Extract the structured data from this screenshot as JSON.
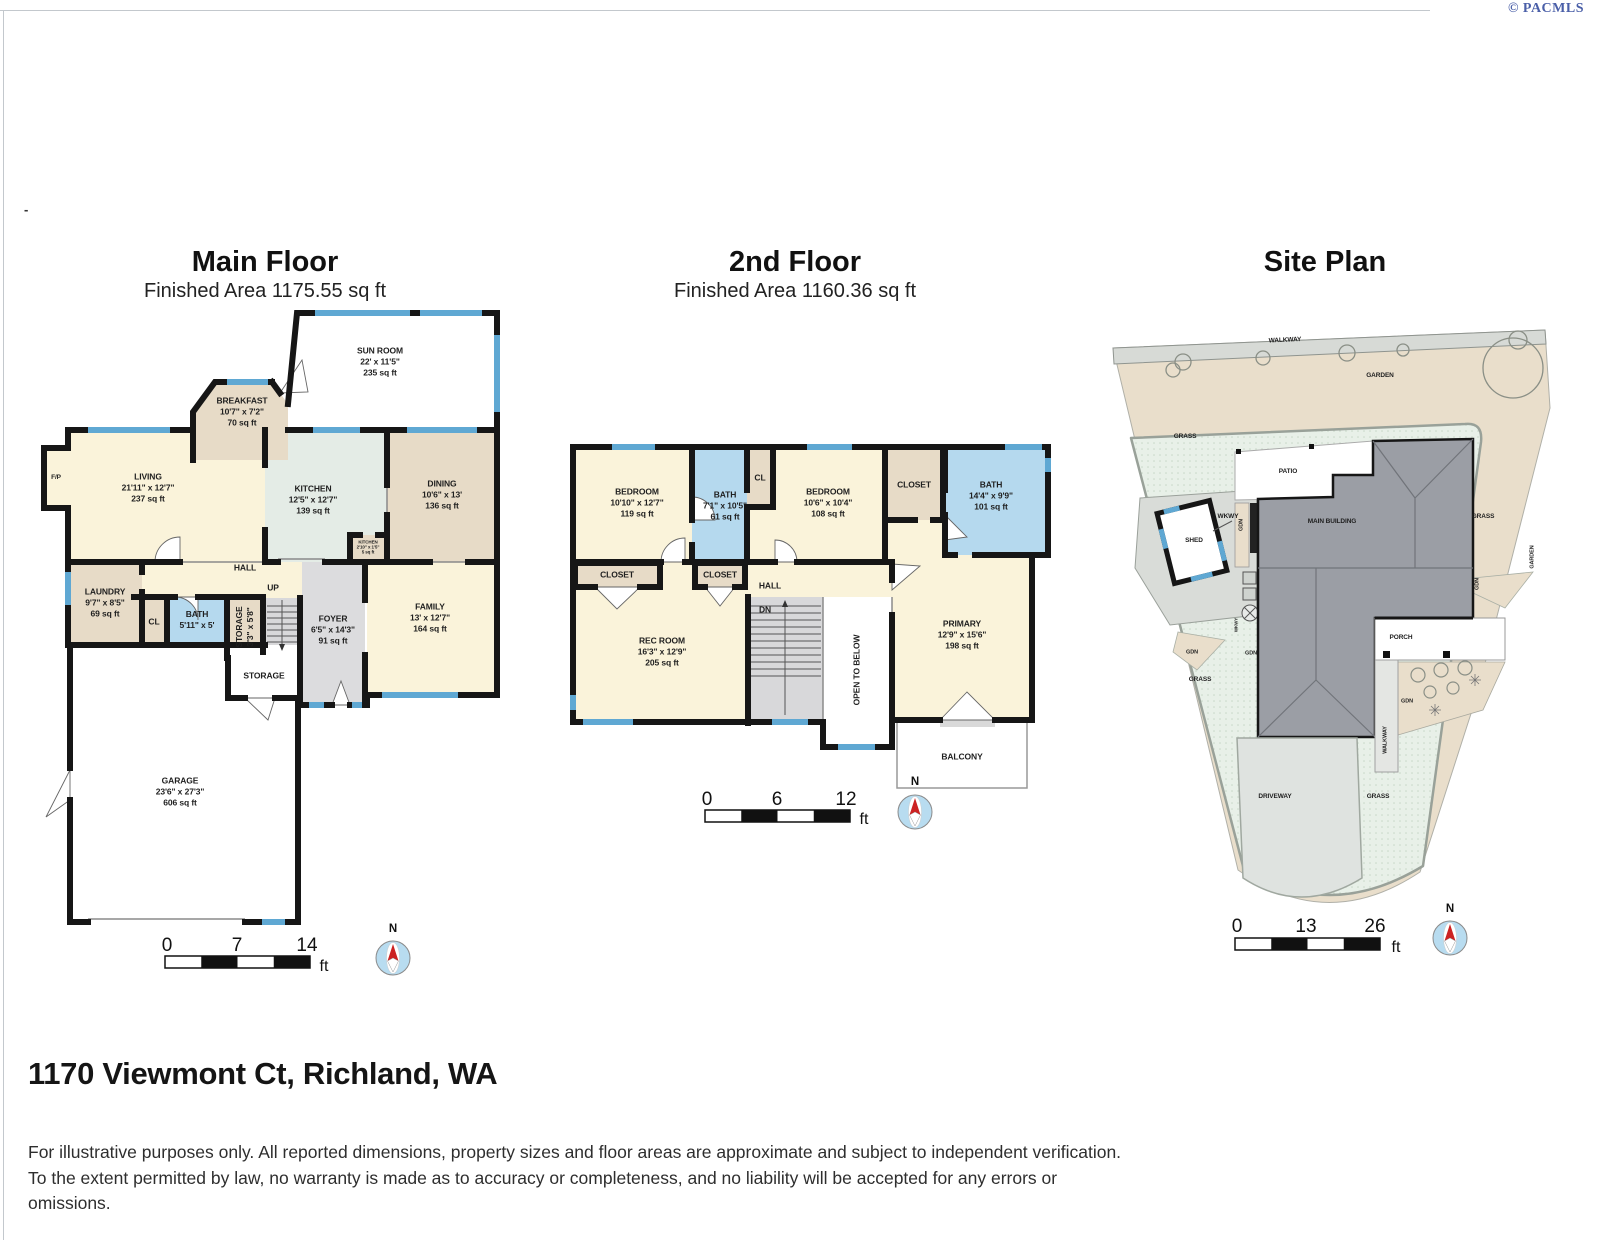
{
  "watermark": "© PACMLS",
  "dash": "-",
  "address": "1170 Viewmont Ct, Richland, WA",
  "disclaimer": "For illustrative purposes only. All reported dimensions, property sizes and floor areas are approximate and subject to independent verification. To the extent permitted by law, no warranty is made as to accuracy or completeness, and no liability will be accepted for any errors or omissions.",
  "colors": {
    "wall": "#161616",
    "window": "#5fa8d3",
    "cream": "#faf3da",
    "tan": "#e7dbc7",
    "kitchen_green": "#e4ece6",
    "bath_blue": "#b5d9ee",
    "gray_room": "#dcdcde",
    "grass": "#e8f0e8",
    "garden": "#e9decb",
    "building": "#9b9ea5"
  },
  "main_floor": {
    "title": "Main Floor",
    "subtitle": "Finished Area 1175.55 sq ft",
    "compass": "N",
    "scale": {
      "start": "0",
      "mid": "7",
      "end": "14",
      "unit": "ft"
    },
    "rooms": {
      "sunroom": {
        "name": "SUN ROOM",
        "dims": "22' x 11'5\"",
        "area": "235 sq ft"
      },
      "breakfast": {
        "name": "BREAKFAST",
        "dims": "10'7\" x 7'2\"",
        "area": "70 sq ft"
      },
      "living": {
        "name": "LIVING",
        "dims": "21'11\" x 12'7\"",
        "area": "237 sq ft"
      },
      "kitchen": {
        "name": "KITCHEN",
        "dims": "12'5\" x 12'7\"",
        "area": "139 sq ft"
      },
      "dining": {
        "name": "DINING",
        "dims": "10'6\" x 13'",
        "area": "136 sq ft"
      },
      "kitchen_closet": {
        "name": "KITCHEN",
        "dims": "2'10\" x 1'5\"",
        "area": "5 sq ft"
      },
      "hall": {
        "name": "HALL"
      },
      "up": {
        "name": "UP"
      },
      "laundry": {
        "name": "LAUNDRY",
        "dims": "9'7\" x 8'5\"",
        "area": "69 sq ft"
      },
      "cl": {
        "name": "CL"
      },
      "bath": {
        "name": "BATH",
        "dims": "5'11\" x 5'"
      },
      "storage_closet": {
        "name": "STORAGE",
        "dims": "3'3\" x 5'8\""
      },
      "foyer": {
        "name": "FOYER",
        "dims": "6'5\" x 14'3\"",
        "area": "91 sq ft"
      },
      "family": {
        "name": "FAMILY",
        "dims": "13' x 12'7\"",
        "area": "164 sq ft"
      },
      "storage": {
        "name": "STORAGE"
      },
      "garage": {
        "name": "GARAGE",
        "dims": "23'6\" x 27'3\"",
        "area": "606 sq ft"
      },
      "fireplace": {
        "name": "F/P"
      }
    }
  },
  "second_floor": {
    "title": "2nd Floor",
    "subtitle": "Finished Area 1160.36 sq ft",
    "compass": "N",
    "scale": {
      "start": "0",
      "mid": "6",
      "end": "12",
      "unit": "ft"
    },
    "rooms": {
      "bedroom1": {
        "name": "BEDROOM",
        "dims": "10'10\" x 12'7\"",
        "area": "119 sq ft"
      },
      "bath1": {
        "name": "BATH",
        "dims": "7'1\" x 10'5\"",
        "area": "61 sq ft"
      },
      "cl": {
        "name": "CL"
      },
      "bedroom2": {
        "name": "BEDROOM",
        "dims": "10'6\" x 10'4\"",
        "area": "108 sq ft"
      },
      "closet_a": {
        "name": "CLOSET"
      },
      "bath2": {
        "name": "BATH",
        "dims": "14'4\" x 9'9\"",
        "area": "101 sq ft"
      },
      "closet_b": {
        "name": "CLOSET"
      },
      "closet_c": {
        "name": "CLOSET"
      },
      "hall": {
        "name": "HALL"
      },
      "dn": {
        "name": "DN"
      },
      "rec_room": {
        "name": "REC ROOM",
        "dims": "16'3\" x 12'9\"",
        "area": "205 sq ft"
      },
      "open_below": {
        "name": "OPEN TO BELOW"
      },
      "primary": {
        "name": "PRIMARY",
        "dims": "12'9\" x 15'6\"",
        "area": "198 sq ft"
      },
      "balcony": {
        "name": "BALCONY"
      }
    }
  },
  "site_plan": {
    "title": "Site Plan",
    "compass": "N",
    "scale": {
      "start": "0",
      "mid": "13",
      "end": "26",
      "unit": "ft"
    },
    "labels": {
      "walkway_top": "WALKWAY",
      "garden": "GARDEN",
      "grass_nw": "GRASS",
      "patio": "PATIO",
      "main_building": "MAIN BUILDING",
      "shed": "SHED",
      "wkwy": "WKWY",
      "gdn_shed": "GDN",
      "grass_e": "GRASS",
      "garden_e": "GARDEN",
      "porch": "PORCH",
      "gdn_e": "GDN",
      "gdn_w": "GDN",
      "gdn_c": "GDN",
      "wkwy_c": "WKWY",
      "gdn_plants": "GDN",
      "grass_sw": "GRASS",
      "walkway_side": "WALKWAY",
      "driveway": "DRIVEWAY",
      "grass_se": "GRASS"
    }
  }
}
